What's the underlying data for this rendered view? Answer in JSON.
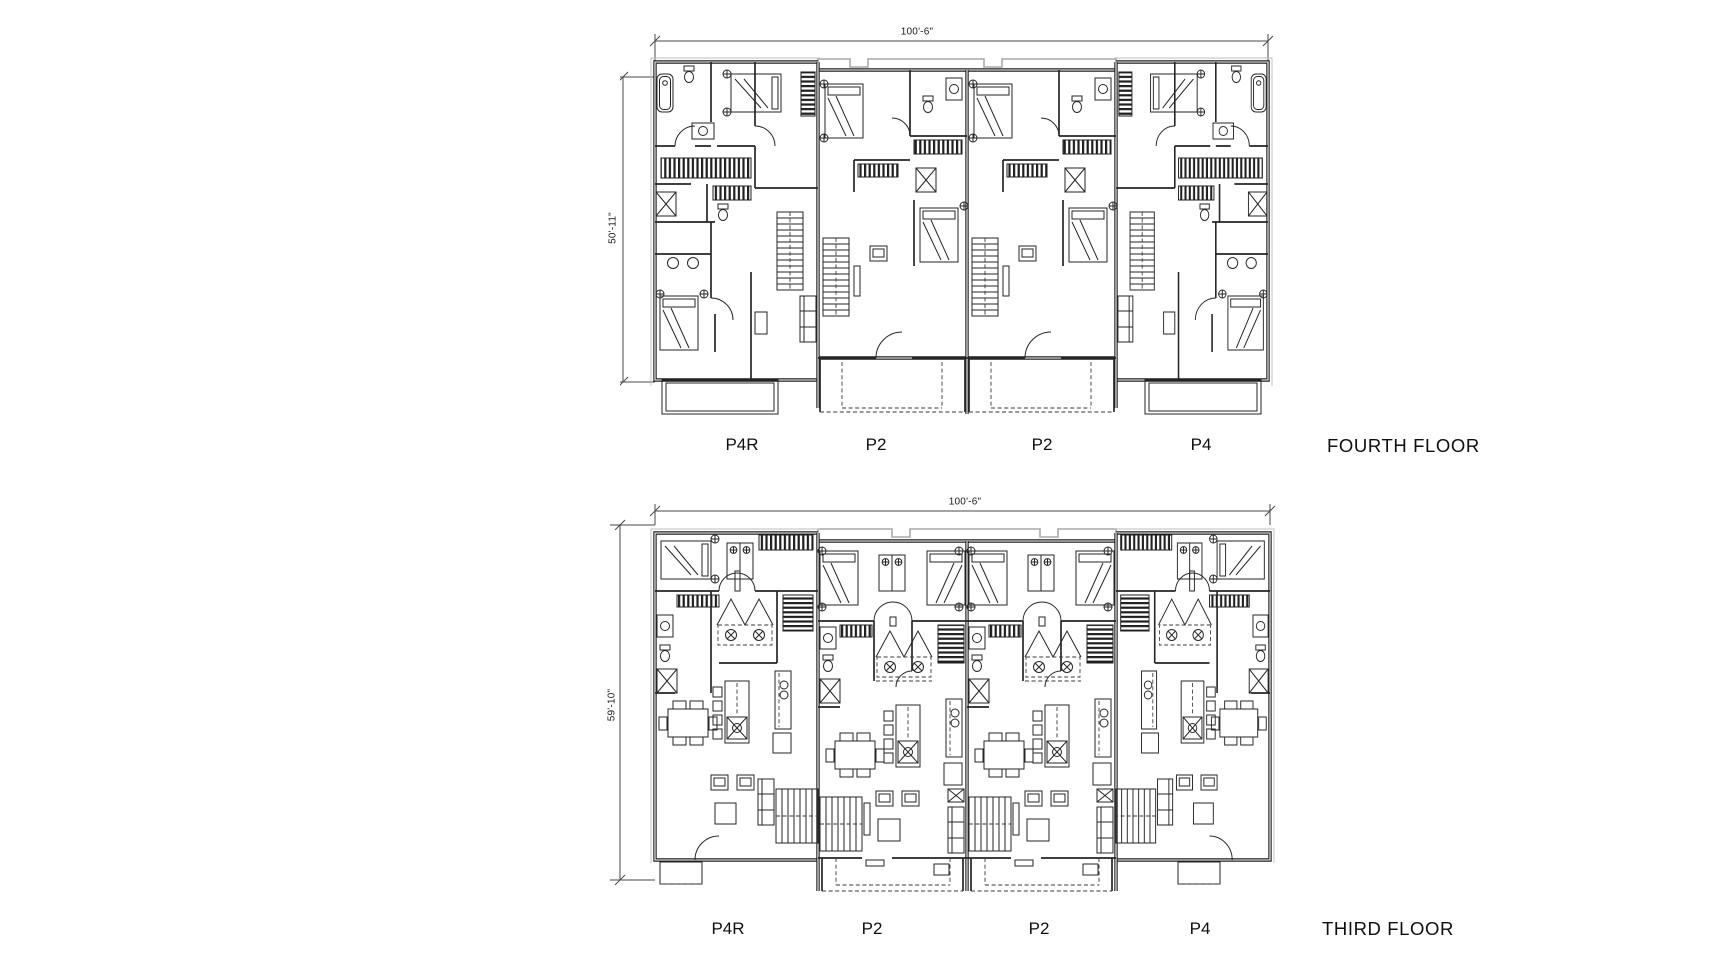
{
  "sheet": {
    "background": "#ffffff",
    "line_color": "#1f1f1f",
    "parapet_color": "#a9a9a9"
  },
  "plans": [
    {
      "id": "fourth",
      "title": "FOURTH FLOOR",
      "width_dim": "100'-6\"",
      "height_dim": "50'-11\"",
      "unit_labels": [
        "P4R",
        "P2",
        "P2",
        "P4"
      ]
    },
    {
      "id": "third",
      "title": "THIRD FLOOR",
      "width_dim": "100'-6\"",
      "height_dim": "59'-10\"",
      "unit_labels": [
        "P4R",
        "P2",
        "P2",
        "P4"
      ]
    }
  ]
}
